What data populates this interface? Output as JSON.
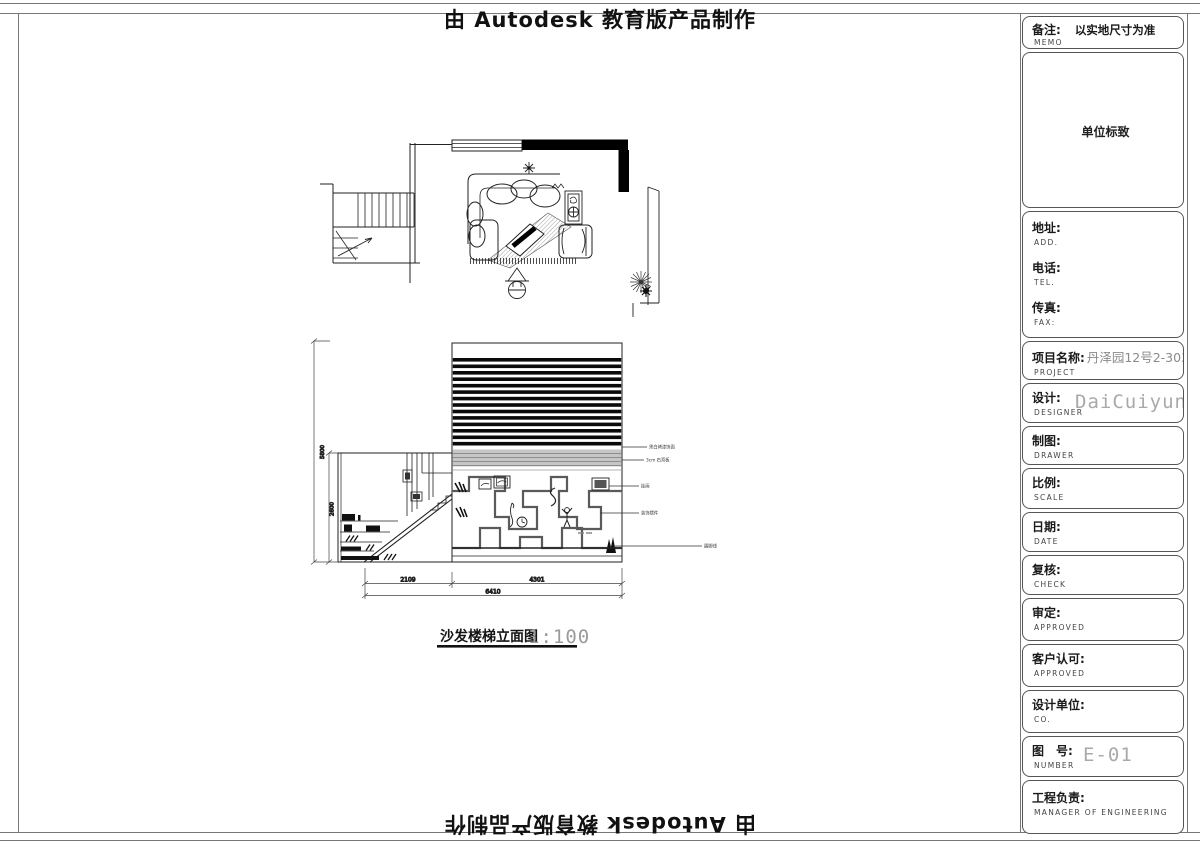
{
  "banners": {
    "top": "由 Autodesk 教育版产品制作",
    "bottom": "由 Autodesk 教育版产品制作"
  },
  "title_block": {
    "memo": {
      "label": "备注:",
      "sub": "MEMO",
      "value": "以实地尺寸为准"
    },
    "logo_box": {
      "value": "单位标致"
    },
    "contact": {
      "address_label": "地址:",
      "address_sub": "ADD.",
      "tel_label": "电话:",
      "tel_sub": "TEL.",
      "fax_label": "传真:",
      "fax_sub": "FAX:"
    },
    "project": {
      "label": "项目名称:",
      "sub": "PROJECT",
      "value": "丹泽园12号2-303—"
    },
    "designer": {
      "label": "设计:",
      "sub": "DESIGNER",
      "value": "DaiCuiyun"
    },
    "drawer": {
      "label": "制图:",
      "sub": "DRAWER"
    },
    "scale": {
      "label": "比例:",
      "sub": "SCALE"
    },
    "date": {
      "label": "日期:",
      "sub": "DATE"
    },
    "check": {
      "label": "复核:",
      "sub": "CHECK"
    },
    "approve": {
      "label": "审定:",
      "sub": "APPROVED"
    },
    "client": {
      "label": "客户认可:",
      "sub": "APPROVED"
    },
    "company": {
      "label": "设计单位:",
      "sub": "CO."
    },
    "number": {
      "label": "图　号:",
      "sub": "NUMBER",
      "value": "E-01"
    },
    "manager": {
      "label": "工程负责:",
      "sub": "MANAGER OF ENGINEERING"
    }
  },
  "drawing": {
    "caption": {
      "title": "沙发楼梯立面图",
      "scale": "1:100"
    },
    "dimensions": {
      "bottom_segments": [
        "2109",
        "4301"
      ],
      "bottom_total": "6410",
      "left_outer": "5800",
      "left_inner": "2600"
    },
    "annotations": [
      "黑白烤漆饰面",
      "3cm 石膏板",
      "挂画",
      "装饰摆件",
      "踢脚线"
    ]
  }
}
